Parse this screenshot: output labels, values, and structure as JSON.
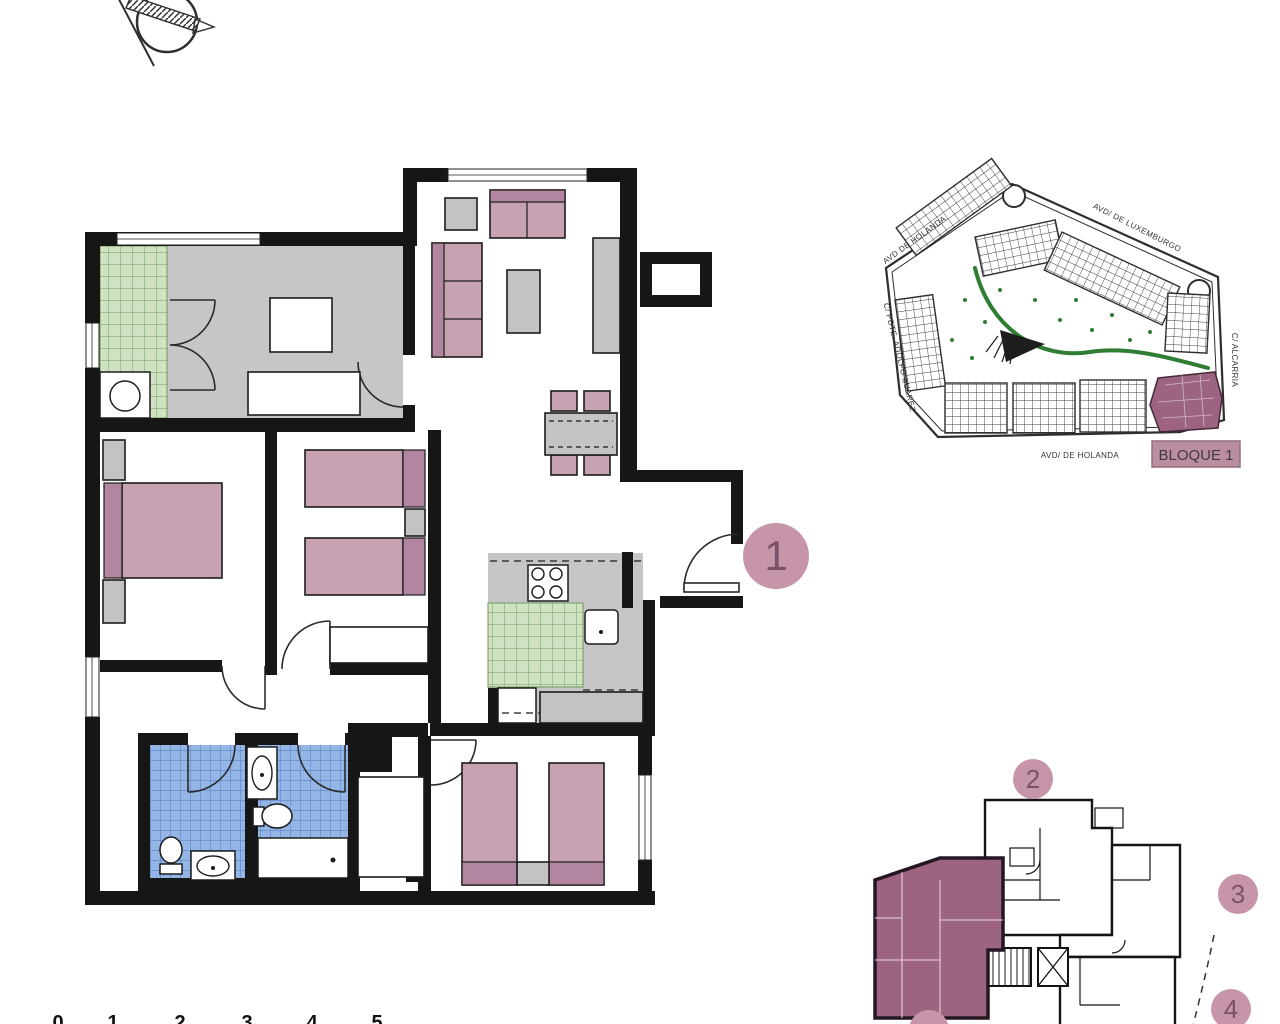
{
  "page": {
    "width": 1280,
    "height": 1024,
    "background": "#ffffff"
  },
  "palette": {
    "wall": "#161616",
    "floor_gray": "#c6c6c6",
    "furniture_pink": "#c7a2b3",
    "furniture_pink_dark": "#b286a0",
    "furniture_gray": "#c3c3c3",
    "tile_green": "#cfe3c2",
    "tile_green_line": "#85ac77",
    "tile_blue": "#93b6e6",
    "tile_blue_line": "#5b84c4",
    "marker_pink": "#c795aa",
    "marker_text": "#7c5168",
    "highlight_block": "#9c6480",
    "green_path": "#2e7d32",
    "bloque_box": "#bb8da1"
  },
  "north_compass": {
    "icon": "north-arrow"
  },
  "main_plan": {
    "unit_marker": "1"
  },
  "site_plan": {
    "block_label": "BLOQUE 1",
    "streets": [
      {
        "id": "holanda-top",
        "label": "AVD DE HOLANDA"
      },
      {
        "id": "luxemburgo",
        "label": "AVD/ DE LUXEMBURGO"
      },
      {
        "id": "adolfo-suarez",
        "label": "C/ PDTE. ADOLFO SUAREZ"
      },
      {
        "id": "alcarria",
        "label": "C/ ALCARRIA"
      },
      {
        "id": "holanda-bottom",
        "label": "AVD/ DE HOLANDA"
      }
    ]
  },
  "key_plan": {
    "unit_markers": [
      "2",
      "3",
      "4"
    ]
  },
  "scale_bar": {
    "ticks": [
      "0",
      "1",
      "2",
      "3",
      "4",
      "5"
    ]
  }
}
